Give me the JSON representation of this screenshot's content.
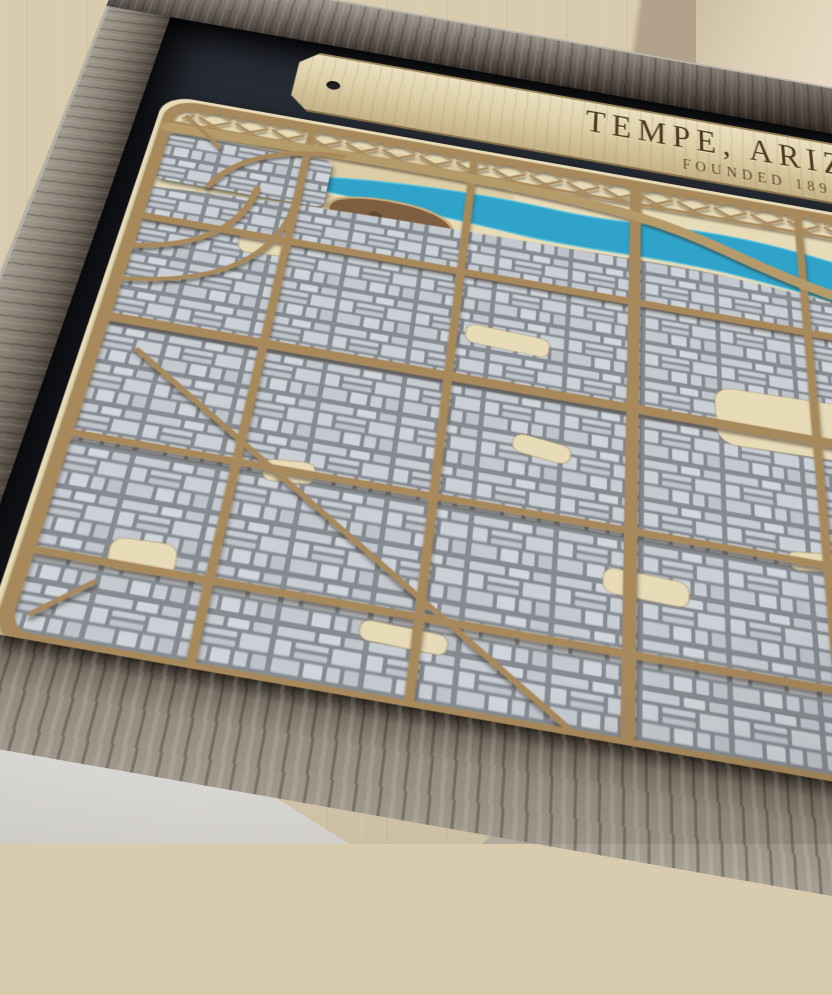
{
  "artwork": {
    "description": "Laser-cut layered wood map of Tempe, Arizona in a weathered grey barnwood frame, photographed at an angle on a table against a plywood wall",
    "plaque": {
      "title": "TEMPE, ARIZONA",
      "subtitle": "FOUNDED 1894"
    }
  },
  "colors": {
    "water": "#2fa3c9",
    "road": "#a8895c",
    "sand": "#e8dbb7",
    "sand_dark": "#d9c79e",
    "butte": "#7d5e41",
    "grid_block": "#c8cdd4",
    "grid_gap": "#868b92",
    "plaque_wood": "#ddd0a8",
    "plaque_text": "#4a3920",
    "backing": "#262a32",
    "frame_grey": "#8a8277",
    "frame_dark": "#4e463e",
    "wall_left": "#d8cbae",
    "wall_mid": "#b3a28b",
    "wall_right": "#ded1b8",
    "table": "#e6e5e2",
    "surface_right": "#bcb5aa"
  }
}
